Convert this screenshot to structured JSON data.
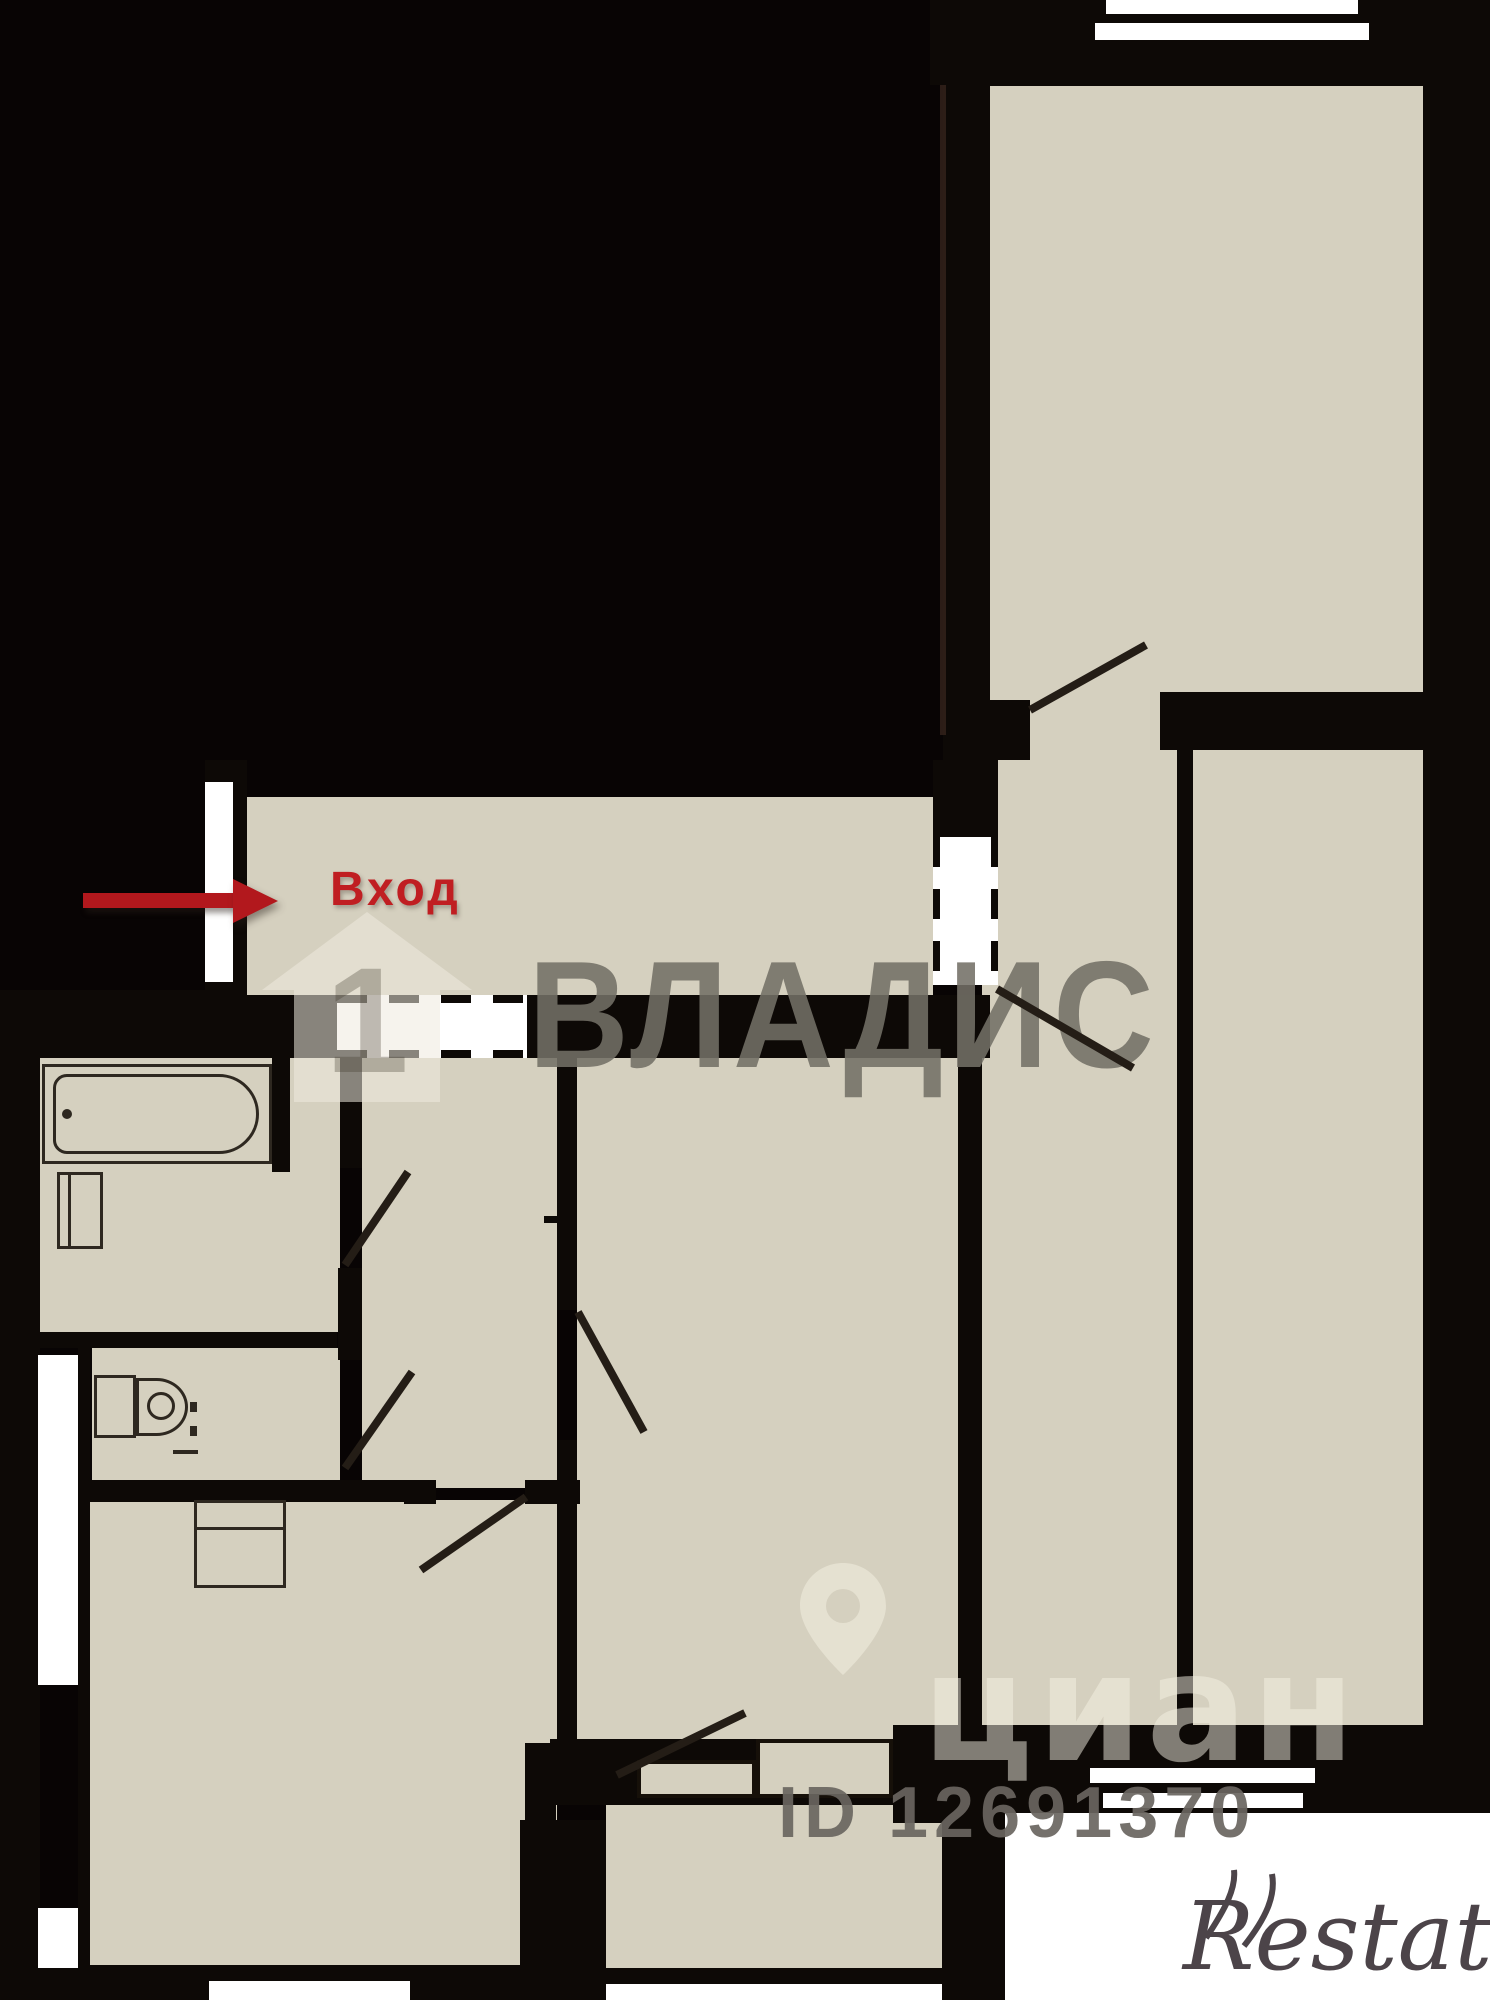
{
  "labels": {
    "entrance": "Вход"
  },
  "watermarks": {
    "vladis": "ВЛАДИС",
    "cian": "циан",
    "listing_id": "ID 12691370",
    "restate": "Restate"
  },
  "colors": {
    "bg": "#080404",
    "room": "#d5d0bf",
    "white": "#ffffff",
    "wall": "#0d0906",
    "line": "#2e2820",
    "door": "#241d16",
    "red": "#c01e22",
    "arrow": "#b2181d",
    "wmgray": "rgba(115,111,103,0.88)",
    "wmcream": "rgba(245,241,228,0.5)",
    "wmid": "rgba(105,101,95,0.92)",
    "restate": "#4c4449"
  },
  "floor_plan": {
    "rooms": [
      {
        "name": "room-top-right",
        "rect": [
          990,
          85,
          433,
          615
        ]
      },
      {
        "name": "window-sill-top",
        "rect": [
          1097,
          40,
          270,
          38
        ]
      },
      {
        "name": "doorway-strip-top-right",
        "rect": [
          990,
          700,
          440,
          60
        ]
      },
      {
        "name": "kitchen-strip",
        "rect": [
          982,
          760,
          195,
          1008
        ]
      },
      {
        "name": "room-right",
        "rect": [
          1193,
          760,
          230,
          965
        ]
      },
      {
        "name": "entrance-hall",
        "rect": [
          247,
          797,
          686,
          198
        ]
      },
      {
        "name": "corridor",
        "rect": [
          362,
          1058,
          195,
          430
        ]
      },
      {
        "name": "bathroom",
        "rect": [
          40,
          1058,
          300,
          274
        ]
      },
      {
        "name": "room-middle",
        "rect": [
          577,
          1058,
          381,
          681
        ]
      },
      {
        "name": "toilet-room",
        "rect": [
          92,
          1348,
          248,
          135
        ]
      },
      {
        "name": "room-bottom-left",
        "rect": [
          90,
          1500,
          467,
          465
        ]
      },
      {
        "name": "room-bottom-middle",
        "rect": [
          606,
          1805,
          336,
          179
        ]
      },
      {
        "name": "sill-bottom-left",
        "rect": [
          199,
          1965,
          222,
          16
        ]
      }
    ],
    "walls": [
      [
        930,
        0,
        560,
        85
      ],
      [
        990,
        78,
        433,
        8
      ],
      [
        943,
        85,
        47,
        675
      ],
      [
        943,
        700,
        87,
        60
      ],
      [
        1160,
        692,
        267,
        58
      ],
      [
        1423,
        0,
        67,
        1770
      ],
      [
        1177,
        750,
        16,
        975
      ],
      [
        933,
        760,
        65,
        77
      ],
      [
        205,
        760,
        42,
        298
      ],
      [
        205,
        995,
        132,
        63
      ],
      [
        527,
        995,
        463,
        63
      ],
      [
        40,
        990,
        165,
        68
      ],
      [
        0,
        990,
        40,
        1010
      ],
      [
        272,
        1058,
        18,
        114
      ],
      [
        340,
        1058,
        22,
        110
      ],
      [
        338,
        1268,
        24,
        92
      ],
      [
        37,
        1332,
        300,
        16
      ],
      [
        78,
        1348,
        12,
        637
      ],
      [
        37,
        1480,
        369,
        22
      ],
      [
        404,
        1480,
        32,
        24
      ],
      [
        525,
        1480,
        55,
        24
      ],
      [
        557,
        1058,
        20,
        252
      ],
      [
        557,
        1440,
        20,
        305
      ],
      [
        958,
        1058,
        24,
        683
      ],
      [
        525,
        1743,
        31,
        242
      ],
      [
        25,
        1965,
        495,
        35
      ],
      [
        550,
        1739,
        343,
        66
      ],
      [
        520,
        1820,
        86,
        180
      ],
      [
        942,
        1820,
        63,
        180
      ],
      [
        606,
        1968,
        336,
        16
      ],
      [
        893,
        1725,
        597,
        98
      ]
    ],
    "white_areas": [
      {
        "name": "window-top-outer",
        "rect": [
          1106,
          0,
          252,
          14
        ]
      },
      {
        "name": "window-top-inner",
        "rect": [
          1095,
          23,
          274,
          17
        ]
      },
      {
        "name": "entrance-door-opening",
        "rect": [
          205,
          782,
          28,
          200
        ]
      },
      {
        "name": "left-niche-upper",
        "rect": [
          38,
          1355,
          40,
          330
        ]
      },
      {
        "name": "left-niche-lower",
        "rect": [
          38,
          1908,
          40,
          60
        ]
      },
      {
        "name": "window-bottom-left",
        "rect": [
          209,
          1981,
          201,
          19
        ]
      },
      {
        "name": "window-bottom-middle",
        "rect": [
          606,
          1984,
          336,
          16
        ]
      },
      {
        "name": "window-right-outer",
        "rect": [
          1090,
          1768,
          225,
          15
        ]
      },
      {
        "name": "window-right-inner",
        "rect": [
          1103,
          1793,
          200,
          15
        ]
      },
      {
        "name": "outside-bottom-right",
        "rect": [
          1005,
          1813,
          485,
          187
        ]
      }
    ],
    "door_swings": [
      {
        "name": "door-room-top-right",
        "line": [
          1030,
          710,
          1146,
          645
        ]
      },
      {
        "name": "door-kitchen-strip",
        "line": [
          997,
          989,
          1133,
          1068
        ]
      },
      {
        "name": "door-bathroom",
        "line": [
          345,
          1265,
          408,
          1172
        ]
      },
      {
        "name": "door-toilet",
        "line": [
          345,
          1468,
          412,
          1372
        ]
      },
      {
        "name": "door-room-middle",
        "line": [
          578,
          1312,
          644,
          1432
        ]
      },
      {
        "name": "door-room-bottom-left",
        "line": [
          526,
          1497,
          421,
          1570
        ]
      },
      {
        "name": "door-closet-middle",
        "line": [
          617,
          1775,
          745,
          1713
        ]
      }
    ],
    "ticks": [
      [
        544,
        1216,
        14,
        7
      ]
    ]
  }
}
